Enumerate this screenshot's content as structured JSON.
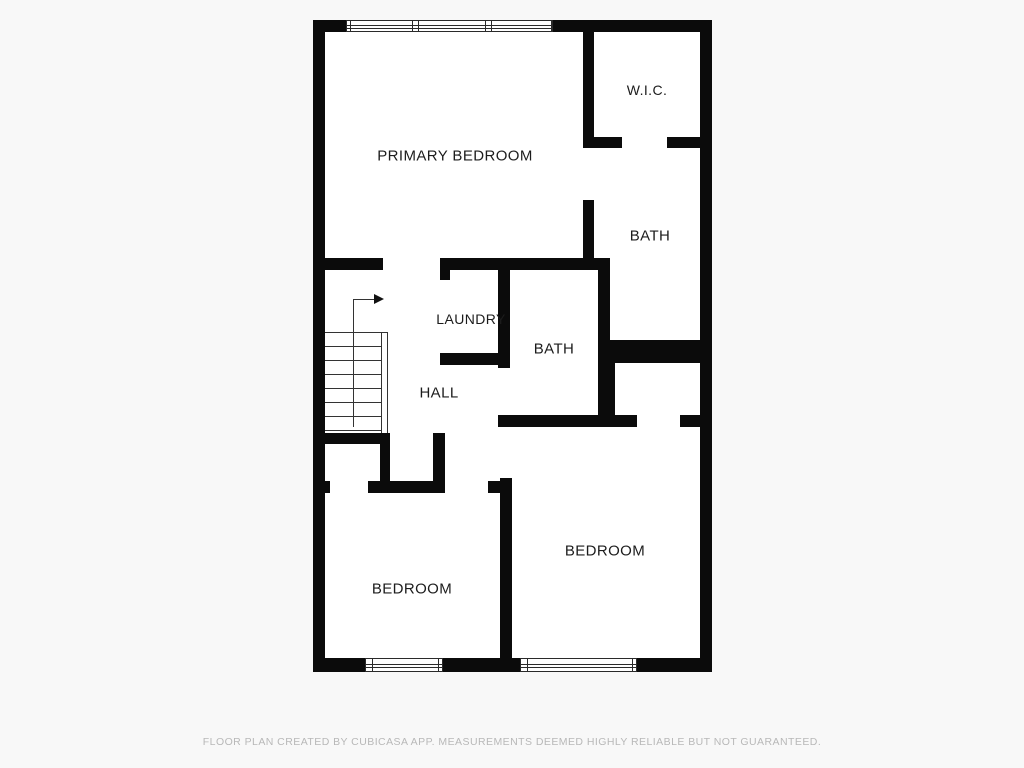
{
  "page": {
    "background": "#f8f8f8",
    "footer_text": "FLOOR PLAN CREATED BY CUBICASA APP. MEASUREMENTS DEEMED HIGHLY RELIABLE BUT NOT GUARANTEED."
  },
  "colors": {
    "wall": "#0b0b0b",
    "floor": "#ffffff",
    "thin_line": "#333333",
    "label": "#1c1c1c",
    "footer": "#b8b8b8"
  },
  "plan": {
    "floor_rect": {
      "x": 313,
      "y": 20,
      "w": 399,
      "h": 652
    },
    "walls": [
      {
        "x": 313,
        "y": 20,
        "w": 33,
        "h": 12
      },
      {
        "x": 553,
        "y": 20,
        "w": 159,
        "h": 12
      },
      {
        "x": 313,
        "y": 20,
        "w": 12,
        "h": 652
      },
      {
        "x": 700,
        "y": 20,
        "w": 12,
        "h": 652
      },
      {
        "x": 313,
        "y": 658,
        "w": 52,
        "h": 14
      },
      {
        "x": 443,
        "y": 658,
        "w": 77,
        "h": 14
      },
      {
        "x": 637,
        "y": 658,
        "w": 75,
        "h": 14
      },
      {
        "x": 313,
        "y": 258,
        "w": 70,
        "h": 12
      },
      {
        "x": 440,
        "y": 258,
        "w": 170,
        "h": 12
      },
      {
        "x": 583,
        "y": 32,
        "w": 11,
        "h": 105
      },
      {
        "x": 583,
        "y": 200,
        "w": 11,
        "h": 70
      },
      {
        "x": 583,
        "y": 137,
        "w": 39,
        "h": 11
      },
      {
        "x": 667,
        "y": 137,
        "w": 33,
        "h": 11
      },
      {
        "x": 598,
        "y": 270,
        "w": 12,
        "h": 157
      },
      {
        "x": 605,
        "y": 340,
        "w": 107,
        "h": 23
      },
      {
        "x": 603,
        "y": 363,
        "w": 12,
        "h": 64
      },
      {
        "x": 680,
        "y": 415,
        "w": 20,
        "h": 12
      },
      {
        "x": 440,
        "y": 258,
        "w": 10,
        "h": 22
      },
      {
        "x": 440,
        "y": 353,
        "w": 62,
        "h": 12
      },
      {
        "x": 498,
        "y": 258,
        "w": 12,
        "h": 110
      },
      {
        "x": 498,
        "y": 415,
        "w": 139,
        "h": 12
      },
      {
        "x": 313,
        "y": 433,
        "w": 75,
        "h": 11
      },
      {
        "x": 380,
        "y": 433,
        "w": 10,
        "h": 58
      },
      {
        "x": 433,
        "y": 433,
        "w": 12,
        "h": 58
      },
      {
        "x": 313,
        "y": 481,
        "w": 17,
        "h": 12
      },
      {
        "x": 368,
        "y": 481,
        "w": 77,
        "h": 12
      },
      {
        "x": 488,
        "y": 481,
        "w": 12,
        "h": 12
      },
      {
        "x": 500,
        "y": 478,
        "w": 12,
        "h": 180
      }
    ],
    "windows": [
      {
        "x": 346,
        "y": 20,
        "w": 207,
        "h": 12,
        "mullions": [
          411,
          417,
          484,
          490
        ],
        "jambs": [
          349,
          550
        ]
      },
      {
        "x": 365,
        "y": 658,
        "w": 78,
        "h": 14,
        "mullions": [],
        "jambs": [
          371,
          437
        ]
      },
      {
        "x": 520,
        "y": 658,
        "w": 117,
        "h": 14,
        "mullions": [],
        "jambs": [
          526,
          631
        ]
      }
    ],
    "stairs": {
      "lines": [
        {
          "x": 325,
          "y": 332,
          "w": 62,
          "h": 1
        },
        {
          "x": 325,
          "y": 346,
          "w": 56,
          "h": 1
        },
        {
          "x": 325,
          "y": 360,
          "w": 56,
          "h": 1
        },
        {
          "x": 325,
          "y": 374,
          "w": 56,
          "h": 1
        },
        {
          "x": 325,
          "y": 388,
          "w": 56,
          "h": 1
        },
        {
          "x": 325,
          "y": 402,
          "w": 56,
          "h": 1
        },
        {
          "x": 325,
          "y": 416,
          "w": 56,
          "h": 1
        },
        {
          "x": 325,
          "y": 430,
          "w": 56,
          "h": 1
        },
        {
          "x": 381,
          "y": 332,
          "w": 1,
          "h": 101
        },
        {
          "x": 387,
          "y": 332,
          "w": 1,
          "h": 101
        },
        {
          "x": 353,
          "y": 299,
          "w": 1,
          "h": 128
        },
        {
          "x": 353,
          "y": 299,
          "w": 22,
          "h": 1
        }
      ],
      "arrowhead": {
        "x": 374,
        "y": 294
      }
    }
  },
  "rooms": [
    {
      "id": "primary-bedroom",
      "label": "PRIMARY BEDROOM",
      "cx": 455,
      "cy": 156,
      "size": 15
    },
    {
      "id": "wic",
      "label": "W.I.C.",
      "cx": 647,
      "cy": 90,
      "size": 14
    },
    {
      "id": "bath-primary",
      "label": "BATH",
      "cx": 650,
      "cy": 236,
      "size": 15
    },
    {
      "id": "laundry",
      "label": "LAUNDRY",
      "cx": 471,
      "cy": 319,
      "size": 14
    },
    {
      "id": "bath-hall",
      "label": "BATH",
      "cx": 554,
      "cy": 349,
      "size": 15
    },
    {
      "id": "hall",
      "label": "HALL",
      "cx": 439,
      "cy": 393,
      "size": 15
    },
    {
      "id": "bedroom-left",
      "label": "BEDROOM",
      "cx": 412,
      "cy": 589,
      "size": 15
    },
    {
      "id": "bedroom-right",
      "label": "BEDROOM",
      "cx": 605,
      "cy": 551,
      "size": 15
    }
  ]
}
